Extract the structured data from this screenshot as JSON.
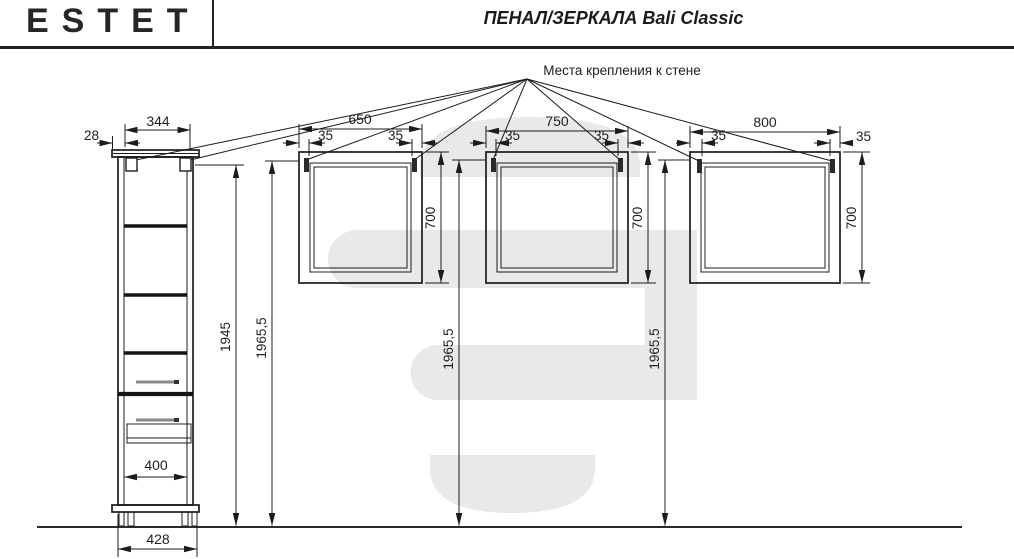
{
  "header": {
    "logo": "ESTET",
    "title": "ПЕНАЛ/ЗЕРКАЛА Bali Classic"
  },
  "drawing": {
    "wall_mount_label": "Места крепления к стене",
    "cabinet": {
      "overhang": "28",
      "top_width": "344",
      "body_height": "1945",
      "total_height": "1965,5",
      "inner_width": "400",
      "base_width": "428"
    },
    "mirrors": [
      {
        "width": "650",
        "offset_left": "35",
        "offset_right": "35",
        "height": "700",
        "mount_height": "1965,5"
      },
      {
        "width": "750",
        "offset_left": "35",
        "offset_right": "35",
        "height": "700",
        "mount_height": "1965,5"
      },
      {
        "width": "800",
        "offset_left": "35",
        "offset_right": "35",
        "height": "700",
        "mount_height": "1965,5"
      }
    ]
  },
  "colors": {
    "line": "#1c1c1c",
    "watermark": "#e9e9e9",
    "handle_gray": "#8a8a8a",
    "text": "#1f1f1f"
  }
}
